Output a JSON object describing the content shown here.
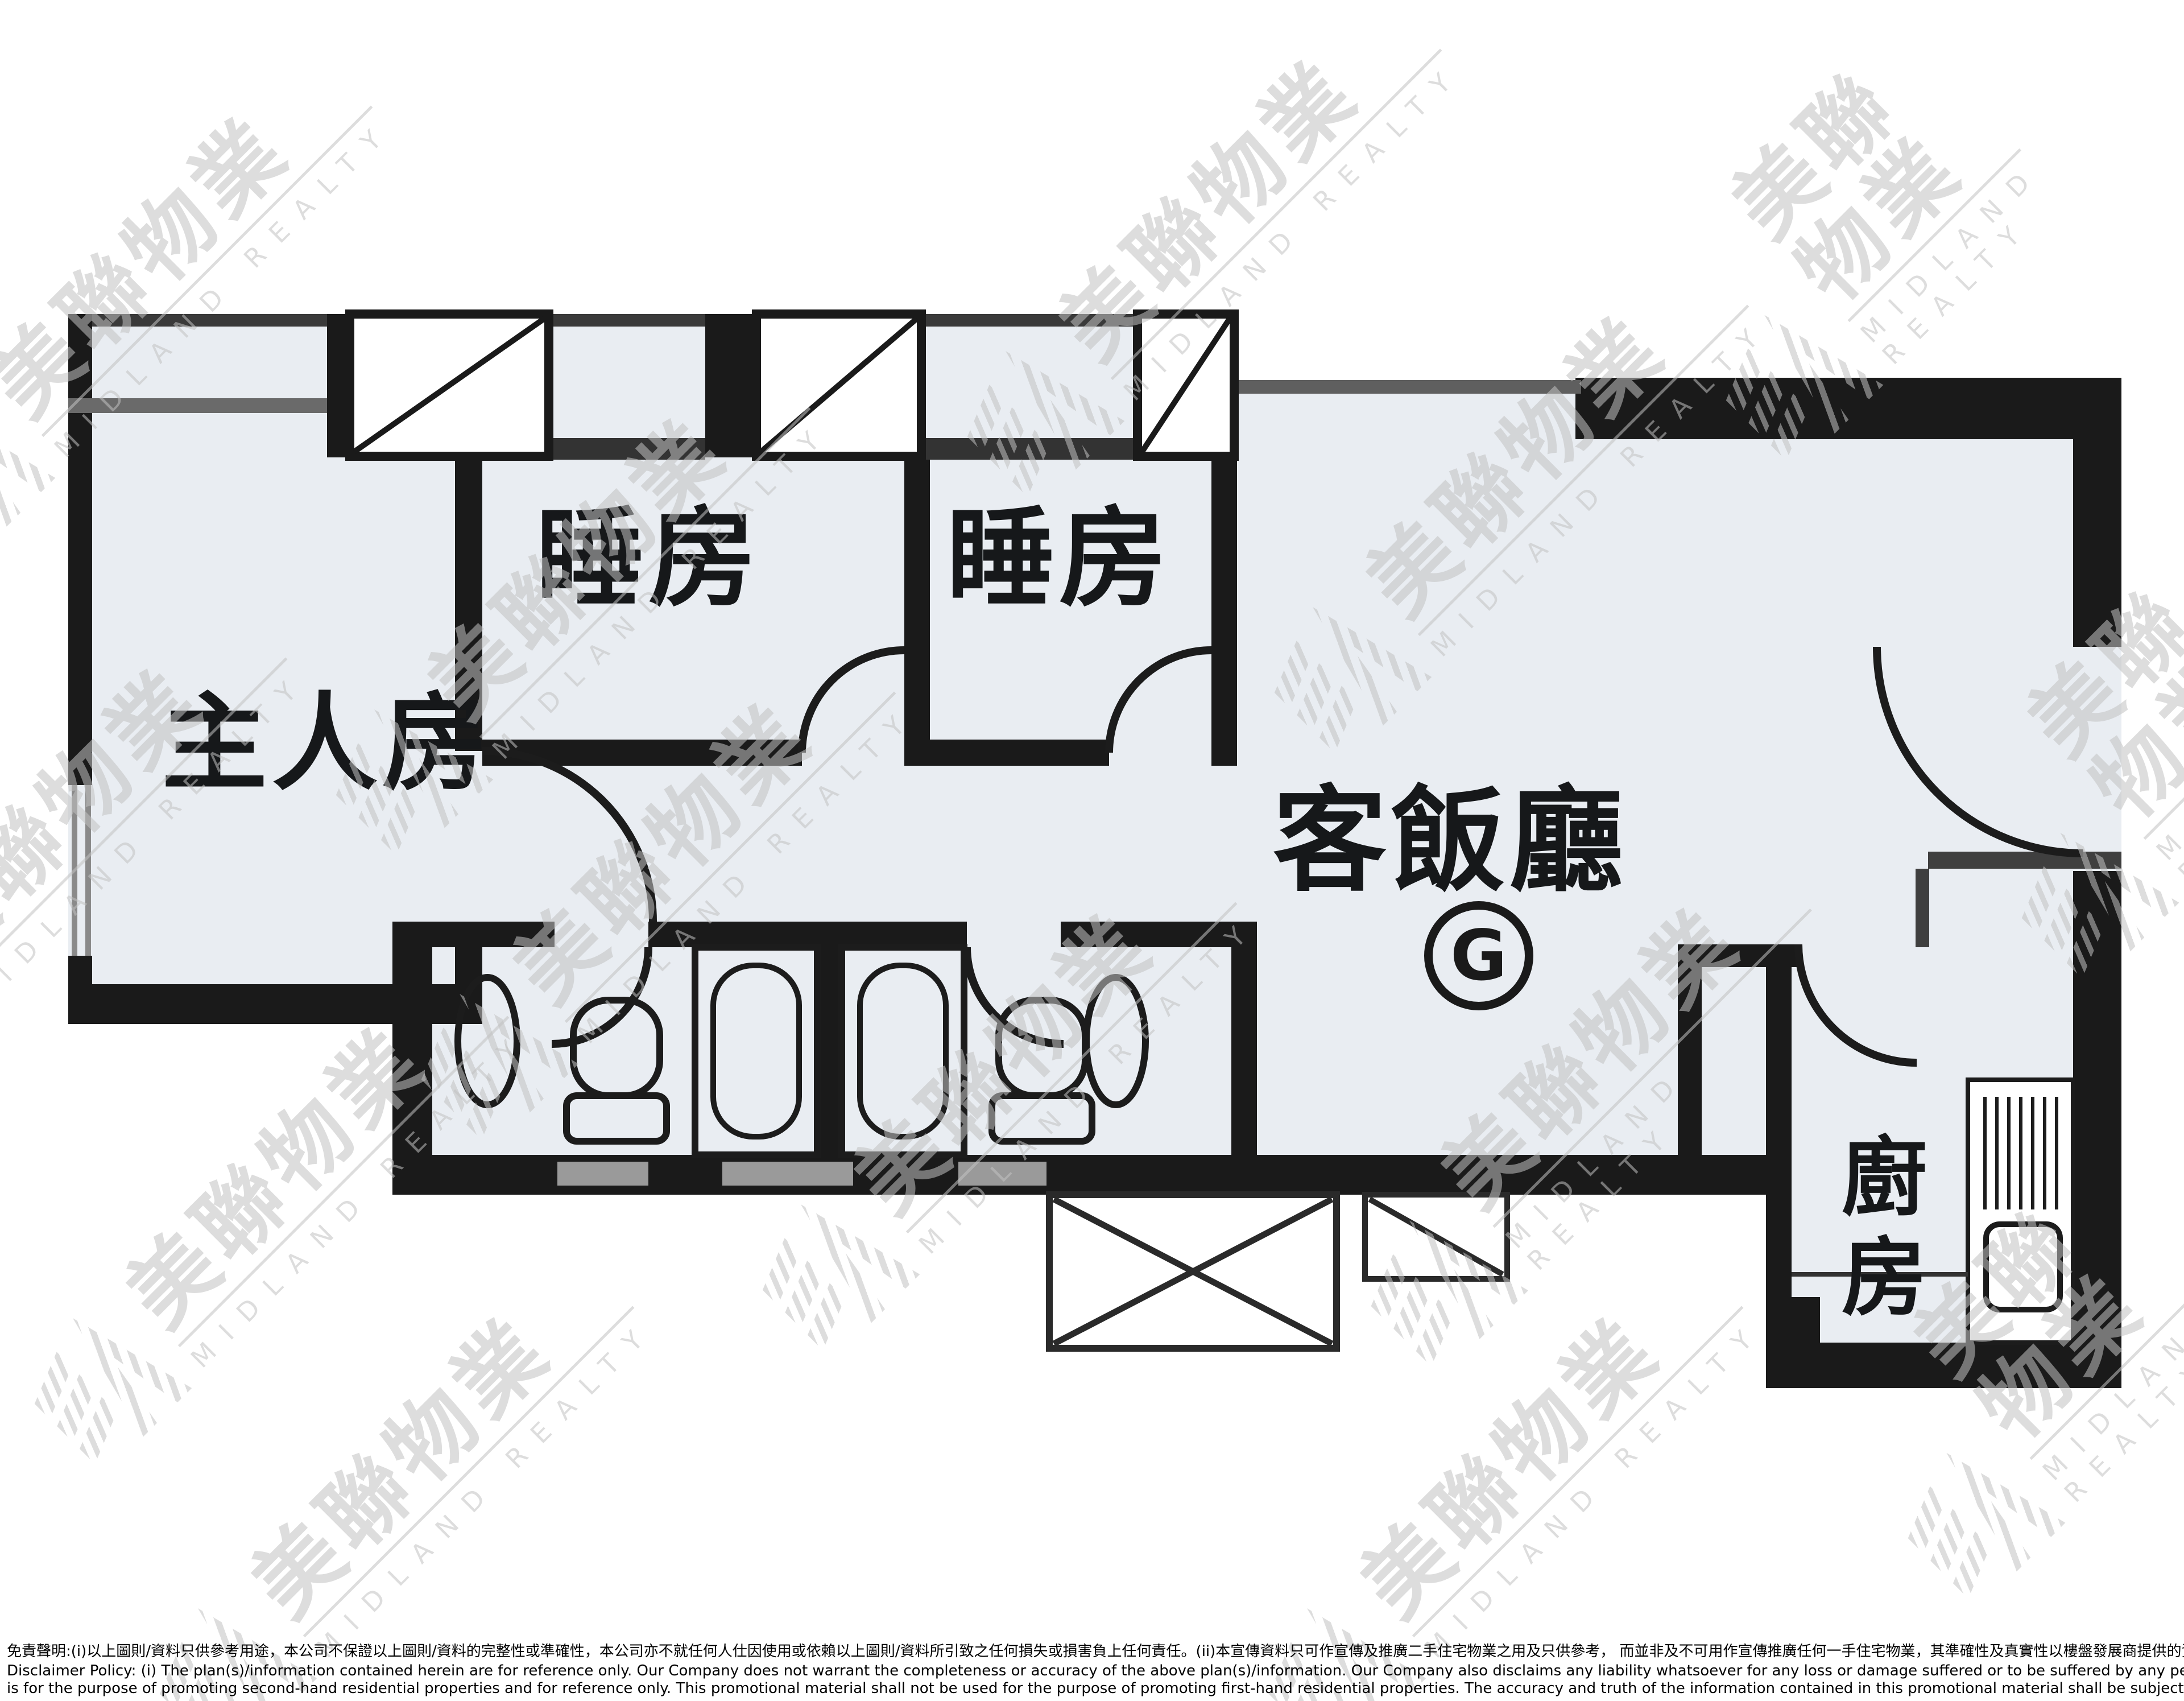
{
  "plan": {
    "master_bedroom": "主人房",
    "bedroom_1": "睡房",
    "bedroom_2": "睡房",
    "living_dining": "客飯廳",
    "kitchen": "廚房",
    "unit_mark": "G"
  },
  "watermark": {
    "cjk": "美聯物業",
    "en": "MIDLAND REALTY"
  },
  "disclaimer": {
    "line1": "免責聲明:(i)以上圖則/資料只供參考用途，本公司不保證以上圖則/資料的完整性或準確性，本公司亦不就任何人仕因使用或依賴以上圖則/資料所引致之任何損失或損害負上任何責任。(ii)本宣傳資料只可作宣傳及推廣二手住宅物業之用及只供參考， 而並非及不可用作宣傳推廣任何一手住宅物業，其準確性及真實性以樓盤發展商提供的資料為準。<br>",
    "line2": "Disclaimer Policy: (i) The plan(s)/information contained herein are for reference only. Our Company does not warrant the completeness or accuracy of the above plan(s)/information. Our Company also disclaims any liability whatsoever for any loss or damage suffered or to be suffered by any person as a result of using or relying on the plan(s)/information. (ii) This promotional material<br>",
    "line3": "is for the purpose of promoting second-hand residential properties and for reference only. This promotional material shall not be used for the purpose of promoting first-hand residential properties. The accuracy and truth of the information contained in this promotional material shall be subject to information provided by the developers."
  }
}
